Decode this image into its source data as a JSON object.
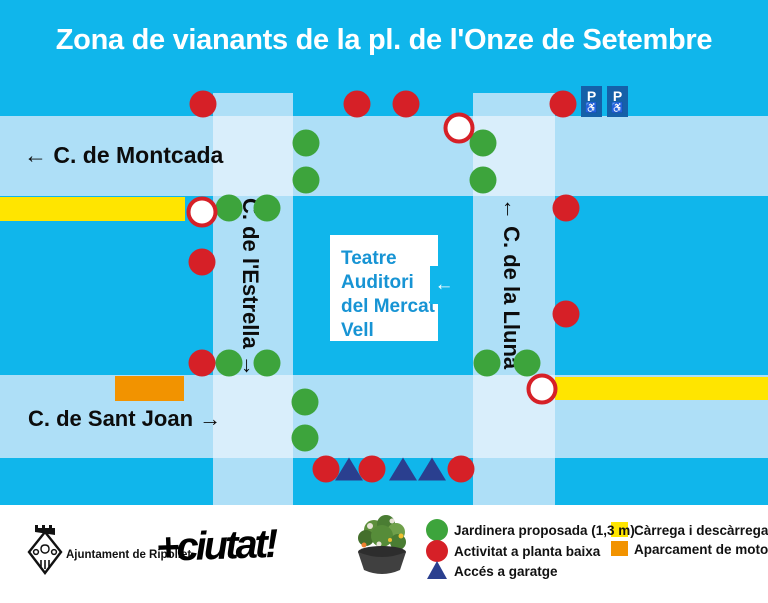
{
  "title": "Zona de vianants de la pl. de l'Onze de Setembre",
  "streets": {
    "montcada": "← C. de Montcada",
    "sant_joan": "C. de Sant Joan →",
    "estrella": "C. de l'Estrella →",
    "lluna": "← C. de la Lluna"
  },
  "building": {
    "name_lines": [
      "Teatre",
      "Auditori",
      "del Mercat",
      "Vell"
    ],
    "entrance_arrow": "←"
  },
  "parking_sign": {
    "letter": "P",
    "accessible_symbol": "♿"
  },
  "legend": {
    "items": [
      {
        "marker": "green-circle",
        "label": "Jardinera proposada (1,3 m)"
      },
      {
        "marker": "red-circle",
        "label": "Activitat a planta baixa"
      },
      {
        "marker": "blue-triangle",
        "label": "Accés a garatge"
      },
      {
        "marker": "yellow-swatch",
        "label": "Càrrega i descàrrega"
      },
      {
        "marker": "orange-swatch",
        "label": "Aparcament de motos"
      }
    ]
  },
  "footer": {
    "municipality": "Ajuntament de Ripollet",
    "brand": "+ciutat!"
  },
  "colors": {
    "background_cyan": "#10B6EB",
    "street_band": "#AEDFF7",
    "street_intersection": "#D9EEFB",
    "green_marker": "#3DA43C",
    "red_marker": "#D62027",
    "garage_triangle": "#2A3F8F",
    "loading_yellow": "#FFE500",
    "moto_orange": "#F29300",
    "parking_sign_blue": "#1560A8",
    "building_text_blue": "#1794D4"
  },
  "map_markers": {
    "green_circles": [
      [
        306,
        143
      ],
      [
        306,
        180
      ],
      [
        483,
        143
      ],
      [
        483,
        180
      ],
      [
        229,
        208
      ],
      [
        267,
        208
      ],
      [
        229,
        363
      ],
      [
        267,
        363
      ],
      [
        487,
        363
      ],
      [
        527,
        363
      ],
      [
        305,
        402
      ],
      [
        305,
        438
      ]
    ],
    "red_circles": [
      [
        203,
        104
      ],
      [
        357,
        104
      ],
      [
        406,
        104
      ],
      [
        563,
        104
      ],
      [
        566,
        208
      ],
      [
        202,
        262
      ],
      [
        566,
        314
      ],
      [
        202,
        363
      ],
      [
        326,
        469
      ],
      [
        372,
        469
      ],
      [
        461,
        469
      ]
    ],
    "open_circles": [
      [
        202,
        212
      ],
      [
        459,
        128
      ],
      [
        542,
        389
      ]
    ],
    "garage_triangles": [
      [
        349,
        469
      ],
      [
        403,
        469
      ],
      [
        432,
        469
      ]
    ]
  }
}
